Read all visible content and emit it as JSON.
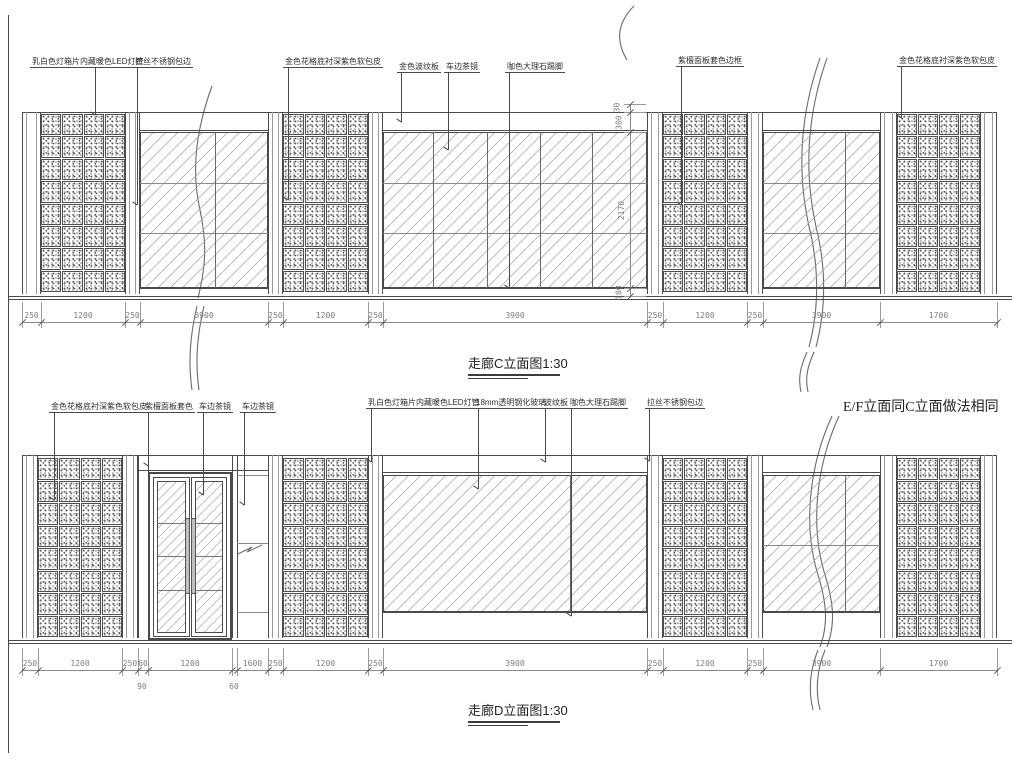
{
  "drawing": {
    "note": "E/F立面同C立面做法相同",
    "elevation_c": {
      "title": "走廊C立面图1:30",
      "callouts": [
        "乳白色灯箱片内藏暖色LED灯管",
        "拉丝不锈钢包边",
        "金色花格底衬深紫色软包皮",
        "金色波纹板",
        "车边茶镜",
        "咖色大理石踢脚",
        "紫檀面板套色边框",
        "金色花格底衬深紫色软包皮"
      ],
      "dims": [
        "250",
        "1200",
        "250",
        "3900",
        "250",
        "1200",
        "250",
        "3900",
        "250",
        "1200",
        "250",
        "3900",
        "1700"
      ],
      "vdims": [
        "30",
        "300",
        "2170",
        "100"
      ]
    },
    "elevation_d": {
      "title": "走廊D立面图1:30",
      "callouts": [
        "金色花格底衬深紫色软包皮",
        "紫檀面板套色",
        "车边茶镜",
        "车边茶镜",
        "乳白色灯箱片内藏暖色LED灯管",
        "18mm透明钢化玻璃",
        "波纹板",
        "咖色大理石踢脚",
        "拉丝不锈钢包边"
      ],
      "dims": [
        "250",
        "1200",
        "250",
        "60",
        "1200",
        "",
        "1600",
        "250",
        "1200",
        "250",
        "3900",
        "250",
        "1200",
        "250",
        "3900",
        "1700"
      ],
      "sub_dims": [
        "90",
        "60"
      ]
    },
    "line_color": "#4a4a4a",
    "background": "#ffffff"
  }
}
